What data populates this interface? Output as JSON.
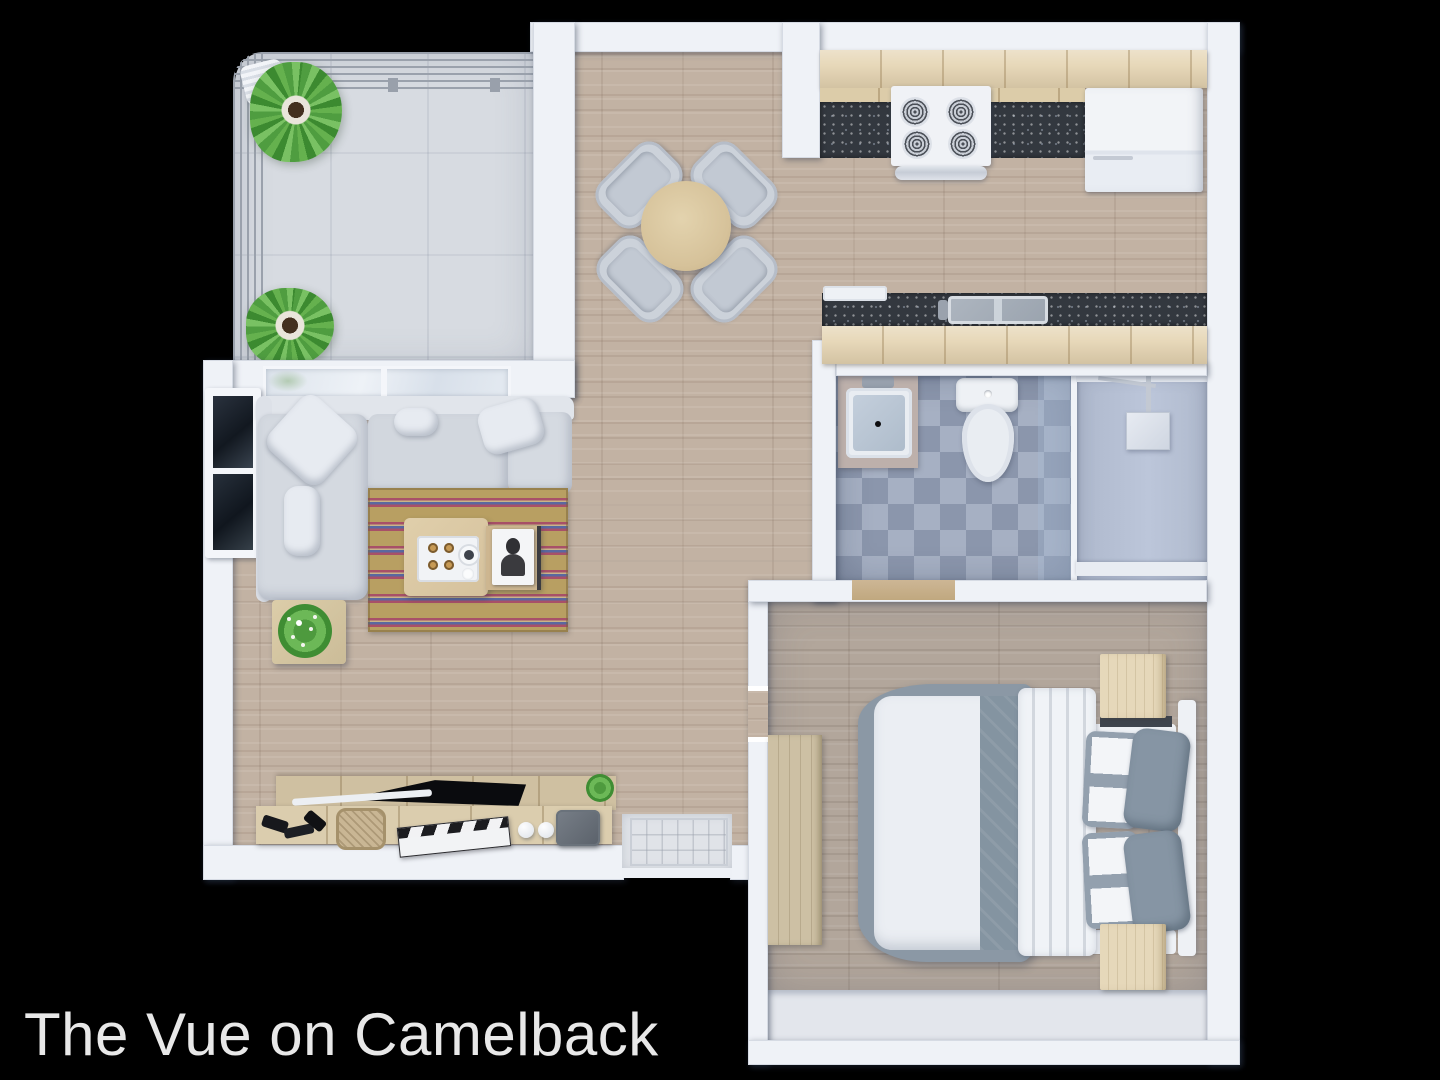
{
  "title": {
    "text": "The Vue on Camelback",
    "color": "#e8e8e8"
  },
  "background_color": "#000000",
  "floorplan": {
    "type": "3d-top-down-apartment-floor-plan",
    "rooms": [
      {
        "id": "balcony",
        "items": [
          "railing",
          "palm-plant",
          "palm-plant",
          "slatted-bench",
          "concrete-floor"
        ]
      },
      {
        "id": "dining-area",
        "items": [
          "round-dining-table",
          "dining-chair",
          "dining-chair",
          "dining-chair",
          "dining-chair"
        ]
      },
      {
        "id": "kitchen",
        "items": [
          "upper-cabinets",
          "granite-counter",
          "stove-4-burner",
          "refrigerator",
          "peninsula-counter",
          "double-sink",
          "white-tray"
        ]
      },
      {
        "id": "living-room",
        "items": [
          "l-shaped-sectional-sofa",
          "throw-pillows",
          "striped-rug",
          "coffee-table",
          "serving-tray",
          "portrait-book",
          "side-table",
          "potted-plant",
          "dark-window",
          "sliding-glass-door",
          "media-console",
          "flat-tv",
          "clapperboard",
          "basket",
          "decor-spheres",
          "storage-box",
          "small-plant"
        ]
      },
      {
        "id": "bathroom",
        "items": [
          "vanity-sink",
          "toilet",
          "walk-in-shower",
          "glass-panel",
          "rain-shower-head",
          "checker-tile-floor"
        ]
      },
      {
        "id": "bedroom",
        "items": [
          "double-bed",
          "gray-accent-runner",
          "folded-sheet",
          "patterned-pillows",
          "gray-pillows",
          "headboard",
          "nightstand",
          "nightstand",
          "wardrobe",
          "closet-nook"
        ]
      },
      {
        "id": "entry",
        "items": [
          "door-mat",
          "front-door-opening"
        ]
      }
    ],
    "colors": {
      "wall": "#eff2f7",
      "wood_floor": "#c2b2a3",
      "bedroom_floor": "#b2a69b",
      "balcony_concrete": "#d7dbe1",
      "cabinet_wood": "#e7d8b9",
      "countertop_granite": "#33383f",
      "sofa": "#d4d9e0",
      "rug_base": "#b89f62",
      "rug_stripe_red": "#a85068",
      "rug_stripe_blue": "#5a68a0",
      "bathroom_tile_dark": "#8b96ac",
      "bathroom_tile_light": "#a6b0c3",
      "shower_floor": "#b3bdd0",
      "bed_duvet": "#ebeef3",
      "bed_accent": "#8494a1",
      "nightstand_wood": "#e6d8ba",
      "plant_green": "#4f9d40",
      "tv_black": "#0a0b0e"
    }
  }
}
